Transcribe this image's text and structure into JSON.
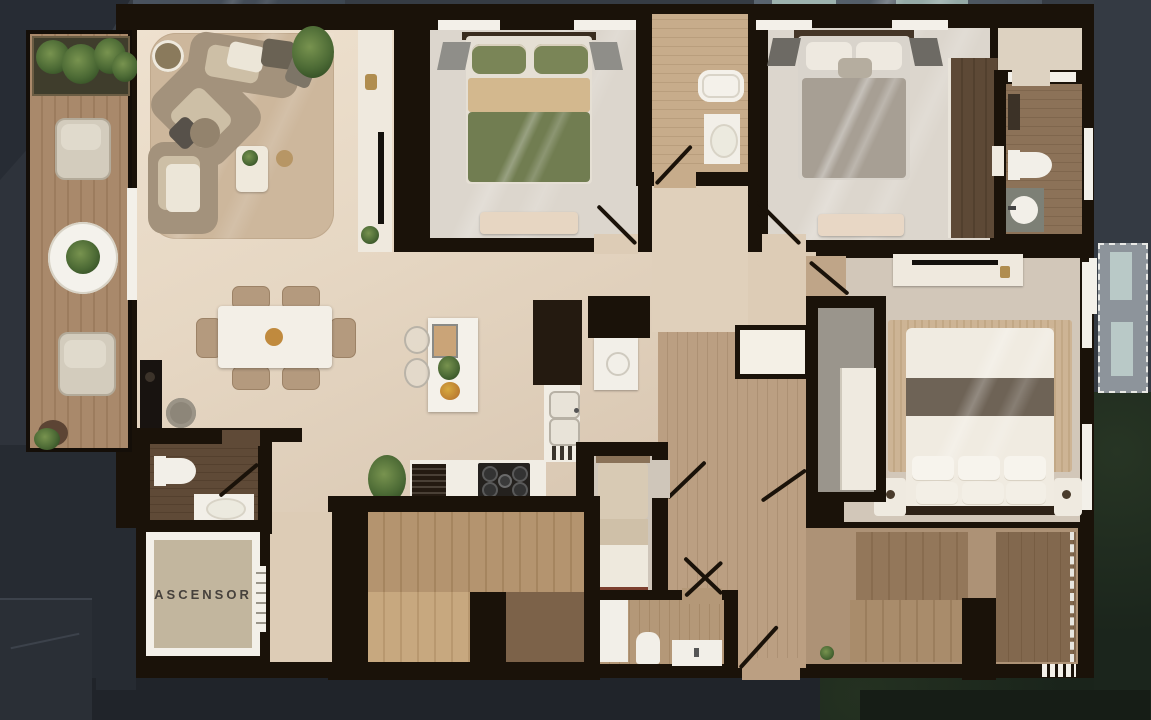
{
  "floorplan": {
    "elevator_label": "ASCENSOR"
  },
  "colors": {
    "wall": "#1a1209",
    "bg": "#363c44",
    "floor": "#e3d4c1",
    "floor2": "#dcd6cd",
    "floor3": "#d2c7b9",
    "wood": "#b89c7f",
    "woodbath": "#c1a685",
    "wooddark": "#5f4a37",
    "deck": "#a8886a",
    "stairs": "#ad8d68",
    "white": "#f3f0e9",
    "greenbed": "#717d51",
    "graybed": "#a79f94",
    "masterband": "#6e6356",
    "rug": "#c9b190",
    "glass": "#515c68",
    "teal": "#9cb2ae",
    "elevator": "#c2b69e"
  }
}
